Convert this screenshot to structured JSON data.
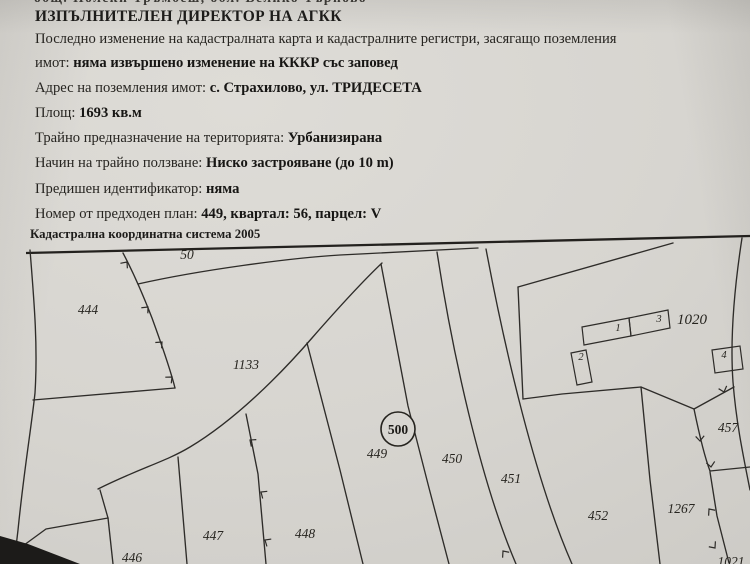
{
  "doc": {
    "top_fragment": "общ. Полски Тръмбеш, обл. Велико Търново",
    "title": "ИЗПЪЛНИТЕЛЕН ДИРЕКТОР НА АГКК",
    "rows": [
      {
        "label": "Последно изменение на кадастралната карта и кадастралните регистри, засягащо поземления",
        "value": ""
      },
      {
        "label": "имот:",
        "value": "няма извършено изменение на КККР със заповед"
      },
      {
        "label": "Адрес на поземления имот:",
        "value": "с. Страхилово, ул. ТРИДЕСЕТА"
      },
      {
        "label": "Площ:",
        "value": "1693 кв.м"
      },
      {
        "label": "Трайно предназначение на територията:",
        "value": "Урбанизирана"
      },
      {
        "label": "Начин на трайно ползване:",
        "value": "Ниско застрояване (до 10 m)"
      },
      {
        "label": "Предишен идентификатор:",
        "value": "няма"
      },
      {
        "label": "Номер от предходен план:",
        "value": "449, квартал: 56, парцел: V"
      }
    ],
    "coord_system": "Кадастрална координатна система 2005"
  },
  "map": {
    "road_label": "50",
    "circle_label": "500",
    "labels": [
      {
        "text": "444"
      },
      {
        "text": "1133"
      },
      {
        "text": "449"
      },
      {
        "text": "450"
      },
      {
        "text": "451"
      },
      {
        "text": "452"
      },
      {
        "text": "1267"
      },
      {
        "text": "457"
      },
      {
        "text": "1021"
      },
      {
        "text": "446"
      },
      {
        "text": "447"
      },
      {
        "text": "448"
      },
      {
        "text": "1020"
      }
    ],
    "buildings": [
      {
        "text": "1"
      },
      {
        "text": "2"
      },
      {
        "text": "3"
      },
      {
        "text": "4"
      }
    ]
  }
}
